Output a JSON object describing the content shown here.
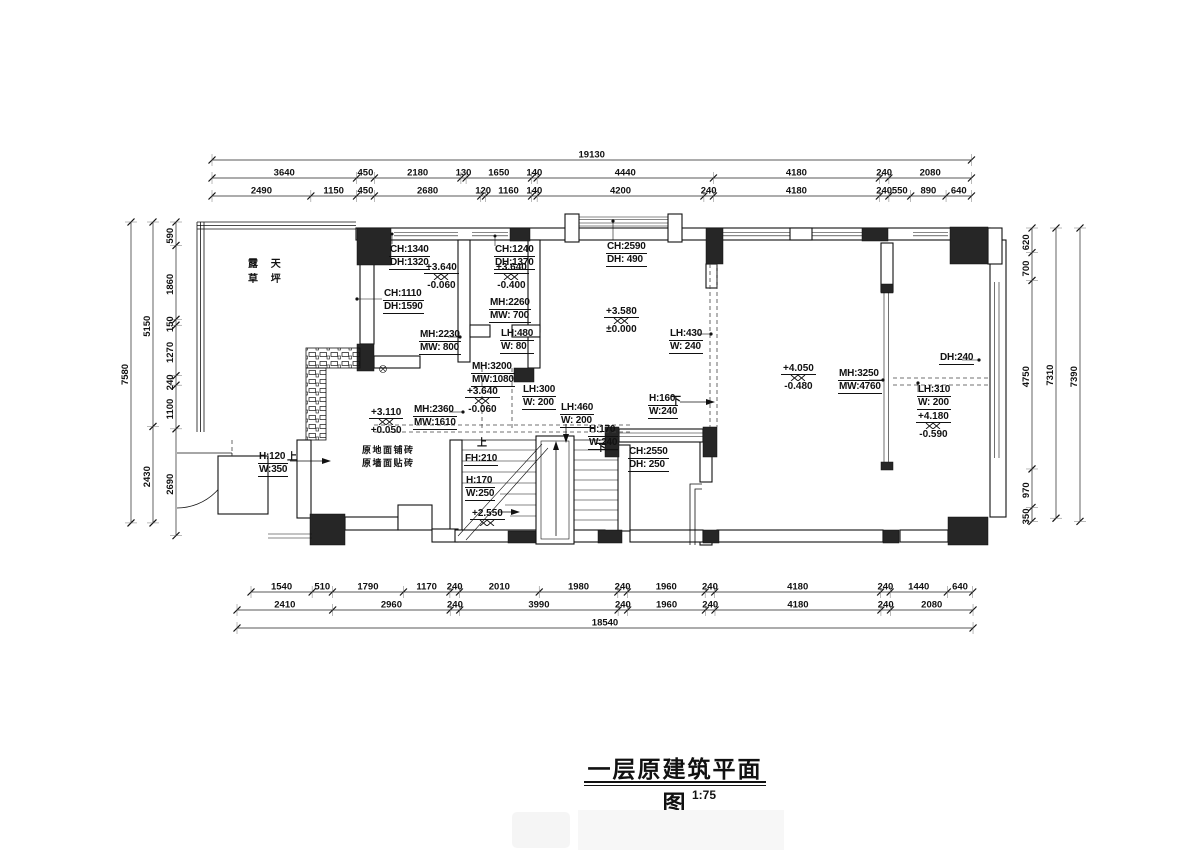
{
  "title": {
    "text": "一层原建筑平面图",
    "scale": "1:75"
  },
  "dims": {
    "top": {
      "overall": [
        "19130"
      ],
      "row1": [
        "3640",
        "450",
        "2180",
        "130",
        "1650",
        "140",
        "4440",
        "4180",
        "240",
        "2080"
      ],
      "row2": [
        "2490",
        "1150",
        "450",
        "2680",
        "120",
        "1160",
        "140",
        "4200",
        "240",
        "4180",
        "240",
        "550",
        "890",
        "640"
      ]
    },
    "bottom": {
      "row1": [
        "1540",
        "510",
        "1790",
        "1170",
        "240",
        "2010",
        "1980",
        "240",
        "1960",
        "240",
        "4180",
        "240",
        "1440",
        "640"
      ],
      "row2": [
        "2410",
        "2960",
        "240",
        "3990",
        "240",
        "1960",
        "240",
        "4180",
        "240",
        "2080"
      ],
      "overall": [
        "18540"
      ]
    },
    "left": {
      "inner": [
        "590",
        "1860",
        "150",
        "1270",
        "240",
        "1100",
        "2690"
      ],
      "mid": [
        "5150",
        "2430"
      ],
      "overall": [
        "7580"
      ]
    },
    "right": {
      "inner": [
        "620",
        "700",
        "4750",
        "970",
        "350"
      ],
      "mid": [
        "7310"
      ],
      "overall": [
        "7390"
      ]
    }
  },
  "notes": {
    "terrace": {
      "l1": "露 天",
      "l2": "草 坪"
    },
    "ch1340": {
      "l1": "CH:1340",
      "l2": "DH:1320"
    },
    "ch1240": {
      "l1": "CH:1240",
      "l2": "DH:1370"
    },
    "ch2590": {
      "l1": "CH:2590",
      "l2": "DH:  490"
    },
    "ch1110": {
      "l1": "CH:1110",
      "l2": "DH:1590"
    },
    "mh2260": {
      "l1": "MH:2260",
      "l2": "MW:  700"
    },
    "mh2230": {
      "l1": "MH:2230",
      "l2": "MW:  800"
    },
    "lh480": {
      "l1": "LH:480",
      "l2": "W:  80"
    },
    "lh430": {
      "l1": "LH:430",
      "l2": "W:  240"
    },
    "mh3200": {
      "l1": "MH:3200",
      "l2": "MW:1080"
    },
    "mh2360": {
      "l1": "MH:2360",
      "l2": "MW:1610"
    },
    "lh300": {
      "l1": "LH:300",
      "l2": "W:  200"
    },
    "lh460": {
      "l1": "LH:460",
      "l2": "W:  200"
    },
    "h160": {
      "l1": "H:160",
      "l2": "W:240"
    },
    "h170_top": {
      "l1": "H:170",
      "l2": "W:240"
    },
    "ch2550": {
      "l1": "CH:2550",
      "l2": "DH:  250"
    },
    "mh3250": {
      "l1": "MH:3250",
      "l2": "MW:4760"
    },
    "dh240": {
      "l1": "DH:240"
    },
    "lh310": {
      "l1": "LH:310",
      "l2": "W:  200"
    },
    "h120": {
      "l1": "H:120",
      "l2": "W:350"
    },
    "paving": {
      "l1": "原地面铺砖",
      "l2": "原墙面贴砖"
    },
    "fh210": {
      "l1": "FH:210"
    },
    "h170_stair": {
      "l1": "H:170",
      "l2": "W:250"
    },
    "up": "上",
    "down": "下"
  },
  "levels": {
    "room1": {
      "top": "+3.640",
      "bot": "-0.060"
    },
    "room2": {
      "top": "+3.640",
      "bot": "-0.400"
    },
    "hall": {
      "top": "+3.580",
      "bot": "±0.000"
    },
    "hall_south": {
      "top": "+3.640",
      "bot": "-0.060"
    },
    "entry": {
      "top": "+3.110",
      "bot": "+0.050"
    },
    "room_right": {
      "top": "+4.050",
      "bot": "-0.480"
    },
    "strip_right": {
      "top": "+4.180",
      "bot": "-0.590"
    },
    "stair": {
      "top": "+2.550"
    }
  }
}
